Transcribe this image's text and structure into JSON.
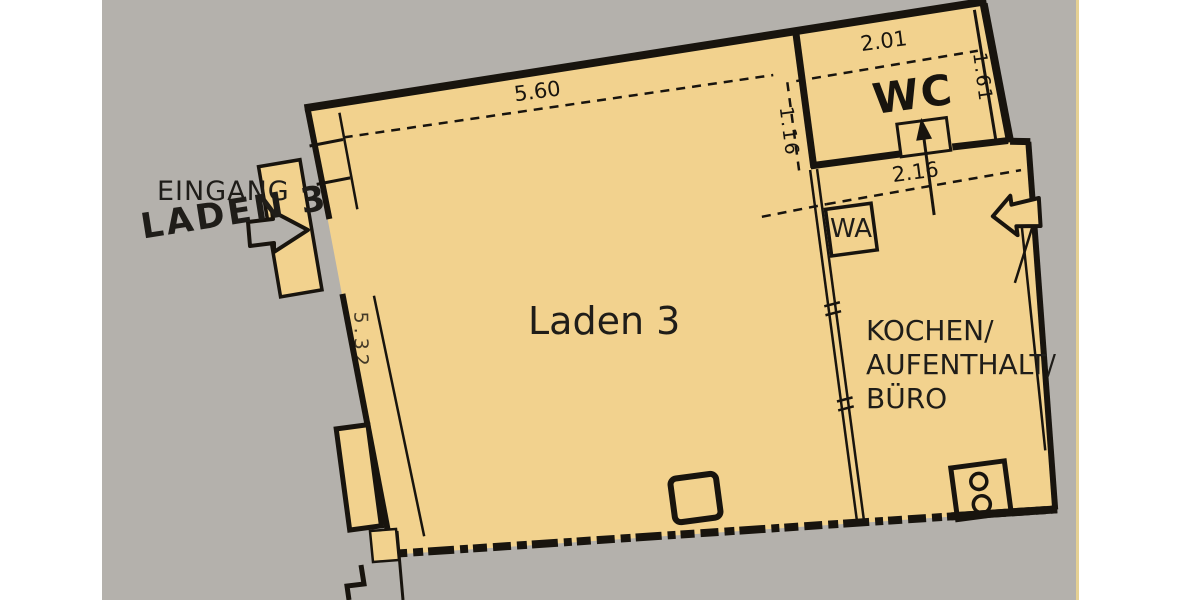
{
  "labels": {
    "eingang": "EINGANG",
    "eingang_name": "LADEN 3",
    "main_room": "Laden 3",
    "wc_room": "WC",
    "washer": "WA",
    "side_room": [
      "KOCHEN/",
      "AUFENTHALT/",
      "BÜRO"
    ]
  },
  "dimensions": {
    "top_width": "5.60",
    "left_height": "5.32",
    "niche_depth": "1.16",
    "wc_width": "2.01",
    "wc_depth": "1.61",
    "hall_width": "2.16"
  },
  "colors": {
    "background": "#b4b1ac",
    "margin_paper": "#ffffff",
    "plan_fill": "#f2d28e",
    "ink": "#18140e",
    "edge_line": "#e5d093"
  },
  "icons": {
    "entrance_arrow": "hand-drawn outline arrow pointing right into shop door",
    "side_entrance_arrow": "outline arrow pointing left into side room",
    "wc_door_arrow": "arrow pointing up through WC door",
    "hob_fixture": "two burner circles in bottom-right corner"
  }
}
